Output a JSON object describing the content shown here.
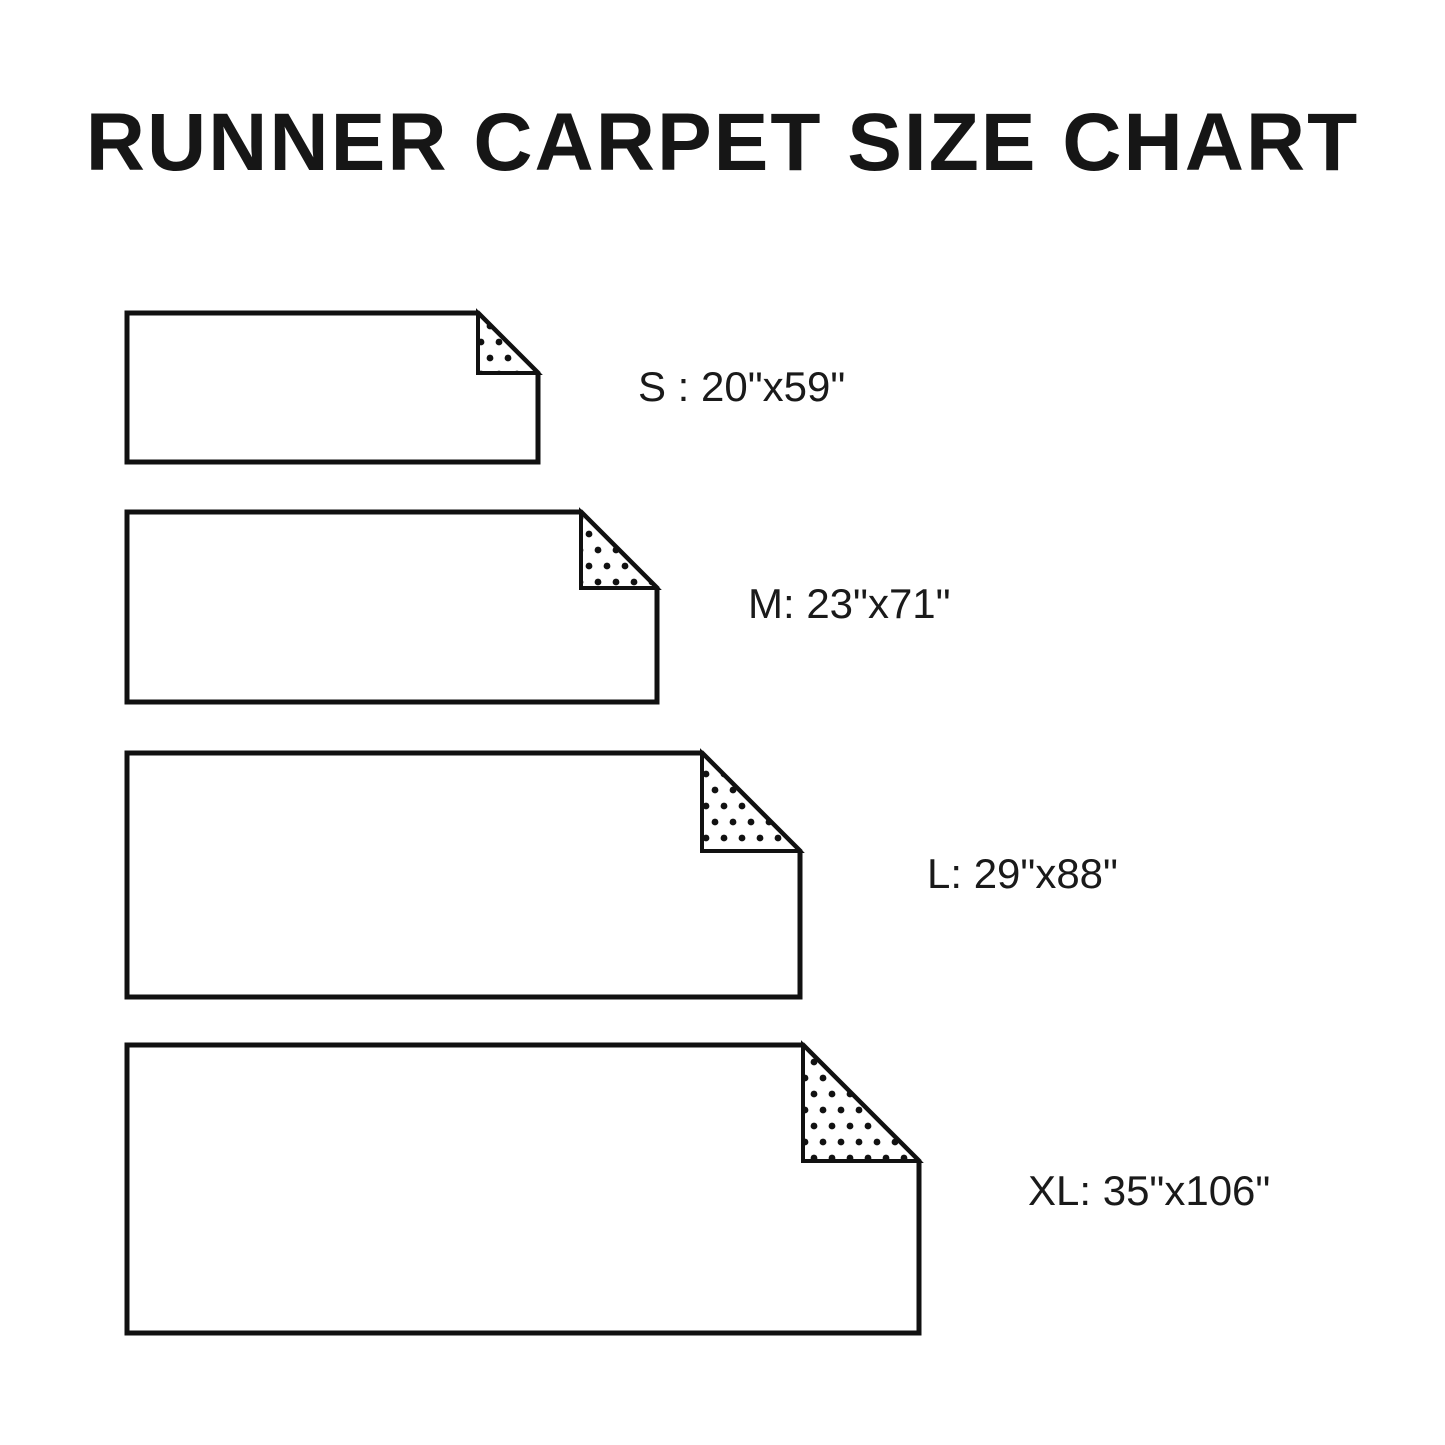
{
  "title": "RUNNER CARPET SIZE CHART",
  "sizes": [
    {
      "code": "S",
      "label": "S : 20\"x59\"",
      "width": "20\"",
      "length": "59\""
    },
    {
      "code": "M",
      "label": "M: 23\"x71\"",
      "width": "23\"",
      "length": "71\""
    },
    {
      "code": "L",
      "label": "L: 29\"x88\"",
      "width": "29\"",
      "length": "88\""
    },
    {
      "code": "XL",
      "label": "XL: 35\"x106\"",
      "width": "35\"",
      "length": "106\""
    }
  ]
}
